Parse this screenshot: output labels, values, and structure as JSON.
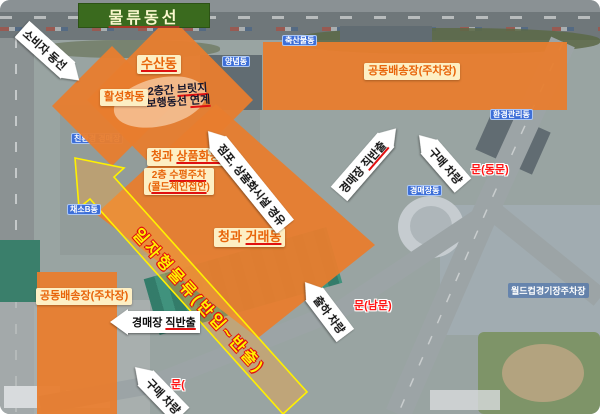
{
  "title": "물류동선",
  "zones": {
    "susan": {
      "u": "수산동"
    },
    "hwalseong": {
      "pre": "활성화동"
    },
    "sangpum": {
      "pre": "청과 ",
      "u": "상품화동"
    },
    "parking2f_l1": {
      "pre": "2층 ",
      "u": "수평주차"
    },
    "parking2f_l2": {
      "pre": "(",
      "u": "콜드체인접안",
      "post": ")"
    },
    "georae": {
      "pre": "청과 ",
      "u": "거래동"
    },
    "baesong_top": {
      "pre": "공동배송장(주차장)"
    },
    "baesong_bottom": {
      "pre": "공동배송장(주차장)"
    }
  },
  "bridge_note": {
    "l1_pre": "2층간 ",
    "l1_u": "브릿지",
    "l2_pre": "보행동선 ",
    "l2_u": "연계"
  },
  "flow_band": {
    "text": "일자형물류(반입~반출)"
  },
  "arrows": {
    "consumer": {
      "text": "소비자 동선"
    },
    "store_via": {
      "text": "점포, 상품화시설 경유"
    },
    "auction_out_right": {
      "pre": "경매장 ",
      "u": "직반출"
    },
    "buy_top": {
      "text": "구매 차량"
    },
    "ship": {
      "text": "출하 차량"
    },
    "buy_bottom": {
      "text": "구매 차량"
    },
    "auction_out_left": {
      "pre": "경매장 ",
      "u": "직반출"
    }
  },
  "gates": {
    "east": "문(동문)",
    "south": "문(남문)",
    "west_partial": "문("
  },
  "building_tags": {
    "chuksan": "축산물동",
    "yangnyeom": "양념동",
    "hwangyeong": "환경관리동",
    "gyeongmae": "경매장동",
    "chaeso_b": "채소B동",
    "chinhwan": "친환경 경매장"
  },
  "area_tags": {
    "worldcup": "월드컵경기장주차장"
  },
  "colors": {
    "zone_orange": "#E87D2E",
    "label_bg": "#FDEFC4",
    "label_text": "#E8640A",
    "title_bg": "#3A6A1E",
    "title_text": "#FBF8CE",
    "band_yellow": "#FFF100",
    "band_outline": "#E01010",
    "underline_red": "#E01010",
    "gate_red": "#FF1414",
    "tag_blue": "#3E6FD8"
  }
}
